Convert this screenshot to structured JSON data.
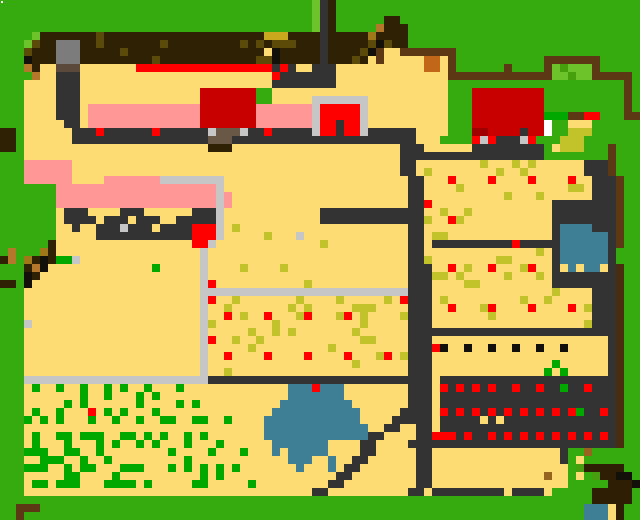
{
  "map": {
    "cols": 80,
    "rows_count": 65,
    "cell_px": 8,
    "width_px": 640,
    "height_px": 520,
    "palette": {
      "G": "#36AB0F",
      "g": "#6CC32A",
      "e": "#46A00E",
      "b": "#00A800",
      "Y": "#FCDC73",
      "P": "#FF9797",
      "D": "#333333",
      "L": "#C6C6C6",
      "U": "#7C7C7C",
      "v": "#5B4A3C",
      "B": "#2E2104",
      "o": "#5C4A08",
      "M": "#C9A81E",
      "m": "#A0781A",
      "F": "#5C3814",
      "t": "#B5772A",
      "c": "#C06818",
      "u": "#6A5847",
      "C": "#C80000",
      "R": "#FF0000",
      "Q": "#A00000",
      "K": "#C2C22A",
      "W": "#FFFFFF",
      "w": "#3E7F96",
      "k": "#121008",
      "d": "#2E1E04",
      "n": "#96641E",
      "f": "#4A2C10"
    },
    "rows": [
      "GGGGGGGGGGGGGGGGGGGGGGGGGGGGGGGGGGGGGGGgDBGGGGGGGGGGGGGGGGGGGGGGGGGGGGGGGGGGGGGG",
      "GGGGGGGGGGGGGGGGGGGGGGGGGGGGGGGGGGGGGGGgDBGGGGGGGGGGGGGGGGGGGGGGGGGGGGGGGGGGGGGG",
      "GGGGGGGGGGGGGGGGGGGGGGGGGGGGGGGGGGGGGGGgDBGGGGGGBBGGGGGGGGGGGGGGGGGGGGGGGGGGGGGG",
      "GGGGGGGGGGGGGGGGGGGGGGGGGGGGGGGGGGGGGGGgDBGGGGGtBBBGGGGGGGGGGGGGGGGGGGGGGGGGGGGG",
      "GGGGgBBBBBBBoBBBBBBBBBBBBBBBBBBBBMMMBBBBDBBBBBmBBBBGGGGGGGGGGGGGGGGGGGGGGGGGGGGG",
      "GGGgoBBUUUBBoBBBBBBBoBBBBBBBBBoBoBoooBBBDBBBBBokoBBGGGGGGGGGGGGGGGGGGGGGGGGGGGGG",
      "GGGoBBBUUUBBBBBoBBBBBBBBBBBBBBBBBYkBBBBBDBBBBokFYYFFFFFFFGGGGGGGGGGGGGGGGGGGGGGG",
      "GGGkBBBUUUBBBBBBBBBoBBBBBBBBBBBBookBBBBBDBBBoBYFYYYYYccYFGGGGGGGGGGGFFFFFFFGGGGG",
      "GGGtBYYvvvYYYYYYYRRRRRRRRRRRRRRRRRDRDYYDDDYYYYYYYYYYYccYFGGGGGGFGGGGFgegggFGGGGG",
      "GGGGtYYDDDYYYYYYYYYYYYYYYYYYYYYYYYRDDDDDDDYYYYYYYYYYYYYYFFFFFFFFFFFFFggeggFFFFFG",
      "GGGYYYYDDDYYYYYYYYYYYYYYYYYYYYYYYYDDDDDDDDYYYYYYYYYYYYYYGGGGGGGGGGGGGGGGGGGGGGFG",
      "GGGYYYYDDDYYYYYYYYYYYYYYYCCCCCCCGGYYYYYYYYYYYYYYYYYYYYYYGGGCCCCCCCCCGGGGGGGGGGFG",
      "GGGYYYYDDDYYYYYYYYYYYYYYYCCCCCCCGGYYYYYLLLLLLLYYYYYYYYYYGGGCCCCCCCCCGGGGGGGGGGFG",
      "GGGYYYYDDDYPPPPPPPPPPPPPPCCCCCCCPPPPPPPLRRRRRLYYYYYYYYYYGGGCCCCCCCCCGGGGGGGGGGFG",
      "GGGYYYYDDDYPPPPPPPPPPPPPPCCCCCCCPPPPPPPLRRRRRLYYYYYYYYYYGGGCCCCCCCCCbbbFFRRGGGFF",
      "GGGYYYYYDDYPPPPPPPPPPPPPPCCCCCCCPPPPPPPLRRDRRLYYYYYYYYYYGGGCCCCCCCCCWGGYYYGGGGGG",
      "BBGYYYYYYDDDRDDDDDDRDDDDDDLuuuLDDRDDDDDLRRDRRLDDDDDDYYYYGGGQQCCCCDCCWGGKKKGGGGGG",
      "BBGYYYYYYDDDDDDDDDDDDDDDDDuuuDDDDDDDDDDDDDDDDDDDDDDDYYYGGGGRLRDDDLRGGGKKKGGGGGGG",
      "BBGYYYYYYYYYYYYYYYYYYYYYYYBBBYYYYYYYYYYYYYYYYYYYYYDDDYYYYYYDDDDDDDDDGYKKKGGGFGG",
      "GGGYYYYYYYYYYYYYYYYYYYYYYYYYYYYYYYYYYYYYYYYYYYYYYYDDDDDDDDDDDDDDDDDDGGGGGGGGFGG",
      "GGGPPPPPPYYYYYYYYYYYYYYYYYYYYYYYYYYYYYYYYYYYYYYYYYDDYYYYYYYYKYYYKYKYYYYYYDDDFGG",
      "GGGPPPPPPYYYYYYYYYYYYYYYYYYYYYYYYYYYYYYYYYYYYYYYYYDDYKYYYYYYYYKYYKYYYYYYYDDDFGG",
      "GGGPPPPPPYYYYPPPPPPPLLLLLLLLYYYYYYYYYYYYYYYYYYYYYYYDDYYYRYYYYRYYYYRYYYYRYYDDDFGG",
      "GGGGGGGPPPPPPPPPPPPPPPPPPPPLYYYYYYYYYYYYYYYYYYYYYYYDDYYYYKYYYYYYYYYYYYYKKYDDDFGG",
      "GGGGGGGPPPPPPPPPPPPPPPPPPPPLPYYYYYYYYYYYYYYYYYYYYYYDDYYYYYYYYYYKYYYKYYYYYYDDDFGG",
      "GGGGGGGPPPPPPPPPPPPPPPPPPPPLPYYYYYYYYYYYYYYYYYYYYYYDDRYYYYYYYYYYYYYYYDDDDDDDDFGG",
      "GGGGGGGYDDDYYYYDDDYYYYYYDDDLYYYYYYYYYYYYDDDDDDDDDDDDDYYKYYKYYYYYYYYYYDDDDDDDDFGG",
      "GGGGGGGYDDDDYDDDYDDDYYDDDDDLYYYYYYYYYYYYDDDDDDDDDDDDDKYYRKYYYYYYYYYYYDDDDDDDDFGG",
      "GGGGGGGYYDYYDDDLDDDYDDDDRRRLYKYYYYYYYYYYYYYYYYYYYYYDDYYYYYYYYYYYYYYYYDwwwwDDDFGG",
      "GGGGGGGYYYYYDDDDDDDDDDDDRRRLYYYYYKYYYLYYYYYYYYYYYYYDDYKKYYYYYYYYYYYYYDwwwwwwDFGG",
      "GGGGGGBYYYYYYYYYYYYYYYYYRRLYYYYYYYYYYYYYKYYYYYYYYYYDDYDDDDDDDDDDRDDDDDwwwwwwDFGG",
      "GtGGGmBYYYYYYYYYYYYYYYYYYLYYYYYYYYYYYYYYYYYYYYYYYYYDDYYYYYYYYYYYYYYKYDwwwwwwDGGG",
      "BtGmBkBbbLYYYYYYYYYYYYYYYLYYYYYYYYYYYYYYYYYYYYYYYYYDDKYYYYYYYYKKYYYYYDwwwwwwDGGG",
      "GGGBtkYYYYYYYYYYYYYbYYYYYLYYYYKYYYYKYYYYYYYYYYYYYYYDDDYYRYKYYRYYYKRYYDYwYwwYDfGG",
      "GGGkBYYYYYYYYYYYYYYYYYYYYLYYYYYYYYYYYYYYYYYYYYYYYYYDDDKKYKYYYYYKYYYKYDDDDDDDDfGG",
      "BBGkYYYYYYYYYYYYYYYYYYYYYLRYYYYYYYYYYYKYYYYYYYYYYYYDDDYYYYKKYYYYYYYYYDDDDDDDDfGG",
      "GGGYYYYYYYYYYYYYYYYYYYYYYLLLLLLLLLLLLLLLLLLLLLLLLLLDDDYYYYYYYYYYYYYYYKYYYYDDDfGG",
      "GGGYYYYYYYYYYYYYYYYYYYYYYLRYYKYYYYYYYKYYYYKYYYYYKYRDDDYKYYYYYYYYYKYYKYYYYYDDDfGG",
      "GGGYYYYYYYYYYYYYYYYYYYYYYLYYKYYYYYYYKYKYYYYYKKKYYYYDDDYYRYYYKRYYYYRYYYYRYKDDDfGG",
      "GGGYYYYYYYYYYYYYYYYYYYYYYLYYRYKYYRYYYKRYYYKRYKYYYYKDDDYYYYYYYKYYYYYYYYYYYYDDDfGG",
      "GGGLYYYYYYYYYYYYYYYYYYYYYLKYYYYYYYKYYYYYYYYYYKYYYYYDDDYYYYYYYYYYYYYYYYYYYKDDDfGG",
      "GGGYYYYYYYYYYYYYYYYYYYYYYLYYYYYKYYKYKYYYYYYYKYYYYYYDDDDDDDDDDDDDDDDDDDDDDDDDDfGG",
      "GGGYYYYYYYYYYYYYYYYYYYYYYLRYYKYYKYYYYYYYYYYYYKKYYYYDDDYYYYYYYYYYYYYYYYYYYYYYDfGG",
      "GGGYYYYYYYYYYYYYYYYYYYYYYLYYYYYKYYYYYYYYYKYYYYYYYYYDDDRkYYkYYkYYkYYkYYkYYYYYDfGG",
      "GGGYYYYYYYYYYYYYYYYYYYYYYLYYRYYYYRYYYYRYYYYRYYYKRYKDDDYYYYYYYYYYYYYYYYYYYYYYDfGG",
      "GGGYYYYYYYYYYYYYYYYYYYYYYLYYYYYYYYYYYYYYYYYYKYYYYYYDDDYYYYYYYYYYYYYYYbYYYYYYDfGG",
      "GGGYYYYYYYYYYYYYYYYYYYYYYLYYKYYYYYYYYYYYYYYYYYYYYYYDDDYYYYYYYYYYYYYYbYbYYYYYDfGG",
      "GGGLLLLLLLLLLLLLLLLLLLLLLLDDDDDDDDDDDDDDDDDDDDDDDDDDDDYDDDDDDDDDDDDDDDDDDDDDDfGG",
      "GGGYbYYbYYbYYbYbYYbYYYbYYYYYYYYYYYYYwwwRwwwYYYYYYYYDDDYRDRDRDRDDRDDRDDbDDRDDDfGG",
      "GGGYYYYYYYbYYbYYYbYbYYYYYYYYYYYYYYYYwwwwwwwYYYYYYYYDDDYDDDDDDDDDDDDDDDDDDDDDDfGG",
      "GGGYYYYYbYbYYYYYYbYYYYbYbYYYYYYYYYYwwwwwwwwwYYYYYYYDDDYDDDDDDDDDDDDDDDDDDDDDDfGG",
      "GGGYbYYbYYYRYbYbYYYbYYYYYYYYYYYYYYwwwwwwwwwwwYYYYYDDDDYRDRDRDRDRDRDRDRDRbDDRDfGG",
      "GGGbYbYbYYYbYYbYYbYYbbYYbbYYbYYYYwwwwwwwwwwwwYYYYDDDDDYDDDDDYDYDDDDDDDDDDDDDDfGG",
      "GGGYYYYYYYYYYYYYYYYYYYYYYYYYYYYYYwwwwwwwwwwwwwYYDDYYDDYDDDDDDDDDDDDDDDDDDDDDDfGG",
      "GGGYbYYbbYbbbYYbbYbYbYYbYbYYYYYYYwwwwwwwwwwwwwDDYYYYDDRRRDRDDRDRDRDRDRDRDRDRDfGG",
      "GGGYbYYYbYYYbYbYYbYbYYYbYYYbYYYYYYwwwwwwwYYYYDDYYYYDDDDDDDDDDDDDDDDDDDDDDDDDDfGG",
      "GGGbbbYYbbYYbYYYYYYYYbYYYYbYYYbYYYwYwwwwwYYYYDDYYYYYDDYYYYYYYYYYYYYYYYDGGnGGGGGG",
      "GGGYYbbbYYbYYbYYYYYYYYYbYYYYYYYYYYYYwwwYYwYYDDYYYYYYDDYYYYYYYYYYYYYYYYDGYGGGGGGG",
      "GGGbbbYYbYbbYYYbbbYYYbYbYbYbYbYYYYYYYwYYYwYDDYYYYYYYDDYYYYYYYYYYYYYYYYYGeddddd",
      "GGGYYYYYbbYYYYbYYYYYYYYYYbYbYYYYYYYYYYYYYYDDYYYYYYYYDDYYYYYYYYYYYYYYnYYGYGeddkk",
      "GGGYbbYbbbYYYbbbbYbYYYYYbbYYYYYbYYYYYYYYYDDYYYYYYYYYDDYYYYYYYYYYYYYYYYYGGGGGdddkk",
      "GGGYYYYYYYYYYYYYYYYYYYYYYYYYYYYYYYYYYYYDDYYYYYYYYYYDDYDDDDDDDDDYDDDDYGGGGGddddd",
      "GGGGGGGGGGGGGGGGGGGGGGGGGGGGGGGGGGGGGGGGGGGGGGGGGGGGGGGGGGGGGGGGGGGGGGGGGGddddd",
      "GGFFFGGGGGGGGGGGGGGGGGGGGGGGGGGGGGGGGGGGGGGGGGGGGGGGGGGGGGGGGGGGGGGGGGGGGwwwYd",
      "GGFGGGGGGGGGGGGGGGGGGGGGGGGGGGGGGGGGGGGGGGGGGGGGGGGGGGGGGGGGGGGGGGGGGGGGGwwwYd"
    ],
    "artifact_dot": {
      "x": 1,
      "y": 1,
      "w": 2,
      "h": 2,
      "color": "#FFFFFF"
    },
    "regions": [
      {
        "name": "tilled-dark-strip",
        "x": 32,
        "y": 32,
        "w": 368,
        "h": 32
      },
      {
        "name": "gray-shed",
        "x": 56,
        "y": 40,
        "w": 24,
        "h": 32
      },
      {
        "name": "red-ribbon-path",
        "x": 136,
        "y": 64,
        "w": 136,
        "h": 8
      },
      {
        "name": "farmhouse-red-top",
        "x": 200,
        "y": 80,
        "w": 56,
        "h": 48
      },
      {
        "name": "small-red-shed",
        "x": 312,
        "y": 96,
        "w": 56,
        "h": 40
      },
      {
        "name": "big-red-barn",
        "x": 472,
        "y": 88,
        "w": 80,
        "h": 56
      },
      {
        "name": "bush-frame",
        "x": 544,
        "y": 56,
        "w": 56,
        "h": 24
      },
      {
        "name": "pink-terrace",
        "x": 56,
        "y": 160,
        "w": 176,
        "h": 48
      },
      {
        "name": "rose-red-bush",
        "x": 192,
        "y": 224,
        "w": 24,
        "h": 24
      },
      {
        "name": "central-road",
        "x": 408,
        "y": 128,
        "w": 24,
        "h": 360
      },
      {
        "name": "orchard-field-upper",
        "x": 432,
        "y": 160,
        "w": 160,
        "h": 104
      },
      {
        "name": "orchard-field-lower",
        "x": 208,
        "y": 296,
        "w": 384,
        "h": 80
      },
      {
        "name": "berry-field-dark",
        "x": 432,
        "y": 376,
        "w": 184,
        "h": 72
      },
      {
        "name": "crop-rows-field",
        "x": 24,
        "y": 384,
        "w": 232,
        "h": 104
      },
      {
        "name": "pond",
        "x": 264,
        "y": 384,
        "w": 104,
        "h": 88
      },
      {
        "name": "water-trough",
        "x": 560,
        "y": 224,
        "w": 48,
        "h": 40
      },
      {
        "name": "bottom-meadow",
        "x": 0,
        "y": 496,
        "w": 640,
        "h": 24
      },
      {
        "name": "corner-pool",
        "x": 600,
        "y": 504,
        "w": 24,
        "h": 16
      },
      {
        "name": "wood-bench",
        "x": 16,
        "y": 504,
        "w": 24,
        "h": 16
      }
    ]
  }
}
